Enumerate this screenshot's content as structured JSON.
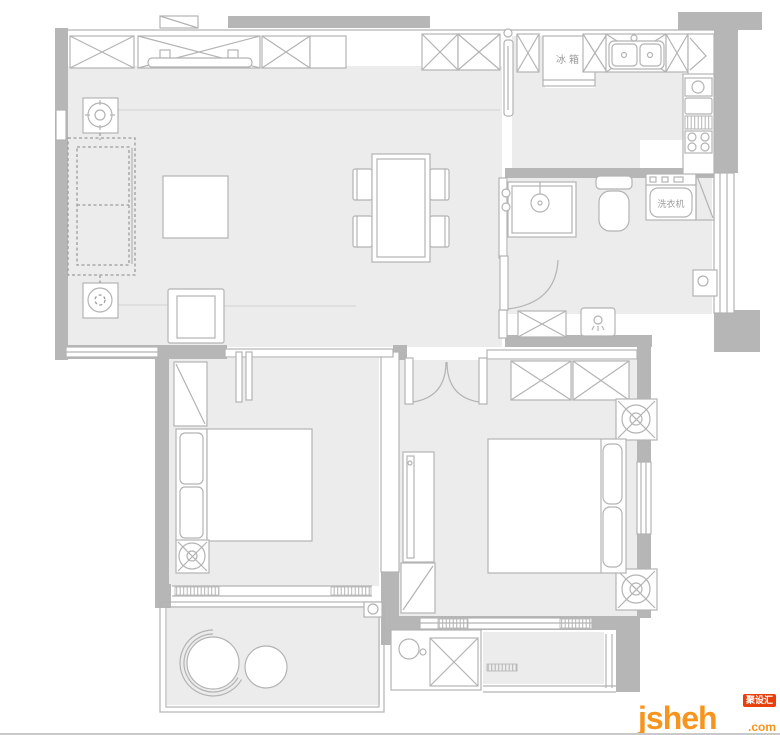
{
  "plan": {
    "labels": {
      "fridge": "冰箱",
      "washing_machine": "洗衣机"
    },
    "colors": {
      "wall": "#b6b6b6",
      "floor": "#ececec",
      "line": "#b3b3b3",
      "background": "#ffffff"
    }
  },
  "watermark": {
    "brand": "jsheh",
    "suffix": ".com",
    "badge": "聚设汇",
    "brand_color": "#f7941d",
    "badge_color": "#e8400c"
  }
}
